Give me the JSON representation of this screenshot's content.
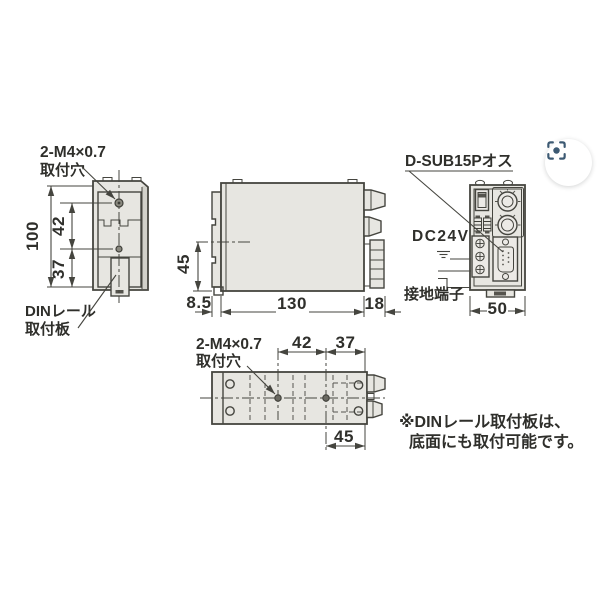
{
  "drawing": {
    "left_view": {
      "hole_note_line1": "2-M4×0.7",
      "hole_note_line2": "取付穴",
      "dim_height_total": "100",
      "dim_hole_pitch": "42",
      "dim_hole_to_bottom": "37",
      "din_note_line1": "DINレール",
      "din_note_line2": "取付板"
    },
    "side_view": {
      "dim_center_height": "45",
      "dim_plate_thickness": "8.5",
      "dim_body_depth": "130",
      "dim_connector_depth": "18"
    },
    "front_view": {
      "connector_note": "D-SUB15Pオス",
      "power_note": "DC24V",
      "ground_note": "接地端子",
      "dim_width": "50"
    },
    "bottom_view": {
      "hole_note_line1": "2-M4×0.7",
      "hole_note_line2": "取付穴",
      "dim_hole_pitch": "42",
      "dim_hole_to_edge": "37",
      "dim_hole_to_right": "45"
    },
    "footnote_line1": "※DINレール取付板は、",
    "footnote_line2": "底面にも取付可能です。"
  },
  "toolbar": {
    "lens_button_icon": "image-search-lens-icon"
  },
  "colors": {
    "line": "#45453f",
    "body_fill": "#e7e6e1",
    "shade": "#d2d1ca",
    "text": "#2f2f2b",
    "lens_icon": "#3d5a73"
  }
}
